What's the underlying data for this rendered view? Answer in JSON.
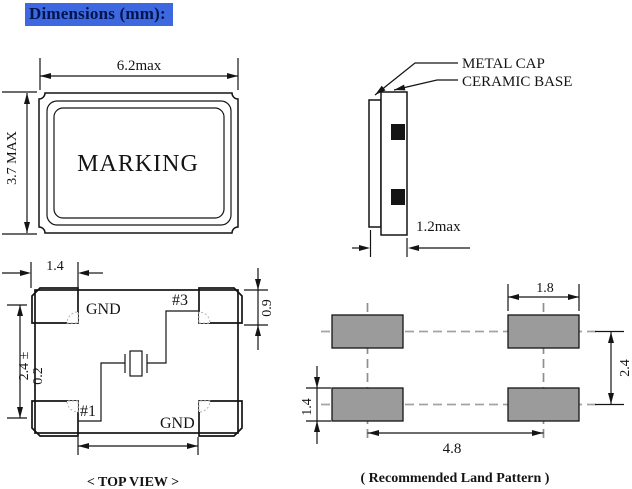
{
  "header": {
    "title": "Dimensions (mm):"
  },
  "top_view": {
    "marking": "MARKING",
    "width_dim": "6.2max",
    "height_dim": "3.7 MAX"
  },
  "side_view": {
    "cap_label": "METAL CAP",
    "base_label": "CERAMIC BASE",
    "thickness_dim": "1.2max"
  },
  "pad_view": {
    "caption": "< TOP VIEW >",
    "pad_top_left": "GND",
    "pad_top_right": "#3",
    "pad_bottom_left": "#1",
    "pad_bottom_right": "GND",
    "dim_corner_pad_width": "1.4",
    "dim_pad_height": "0.9",
    "dim_body_height": "2.4 ±",
    "dim_body_height_tol": "0.2"
  },
  "land_pattern": {
    "caption": "( Recommended Land Pattern )",
    "dim_pad_width": "1.8",
    "dim_pad_height": "1.4",
    "dim_row_pitch": "2.4",
    "dim_col_pitch": "4.8"
  },
  "colors": {
    "highlight": "#3d68df",
    "header_text": "#00154d",
    "land_pad_fill": "#9b9b9b",
    "line": "#141414"
  }
}
